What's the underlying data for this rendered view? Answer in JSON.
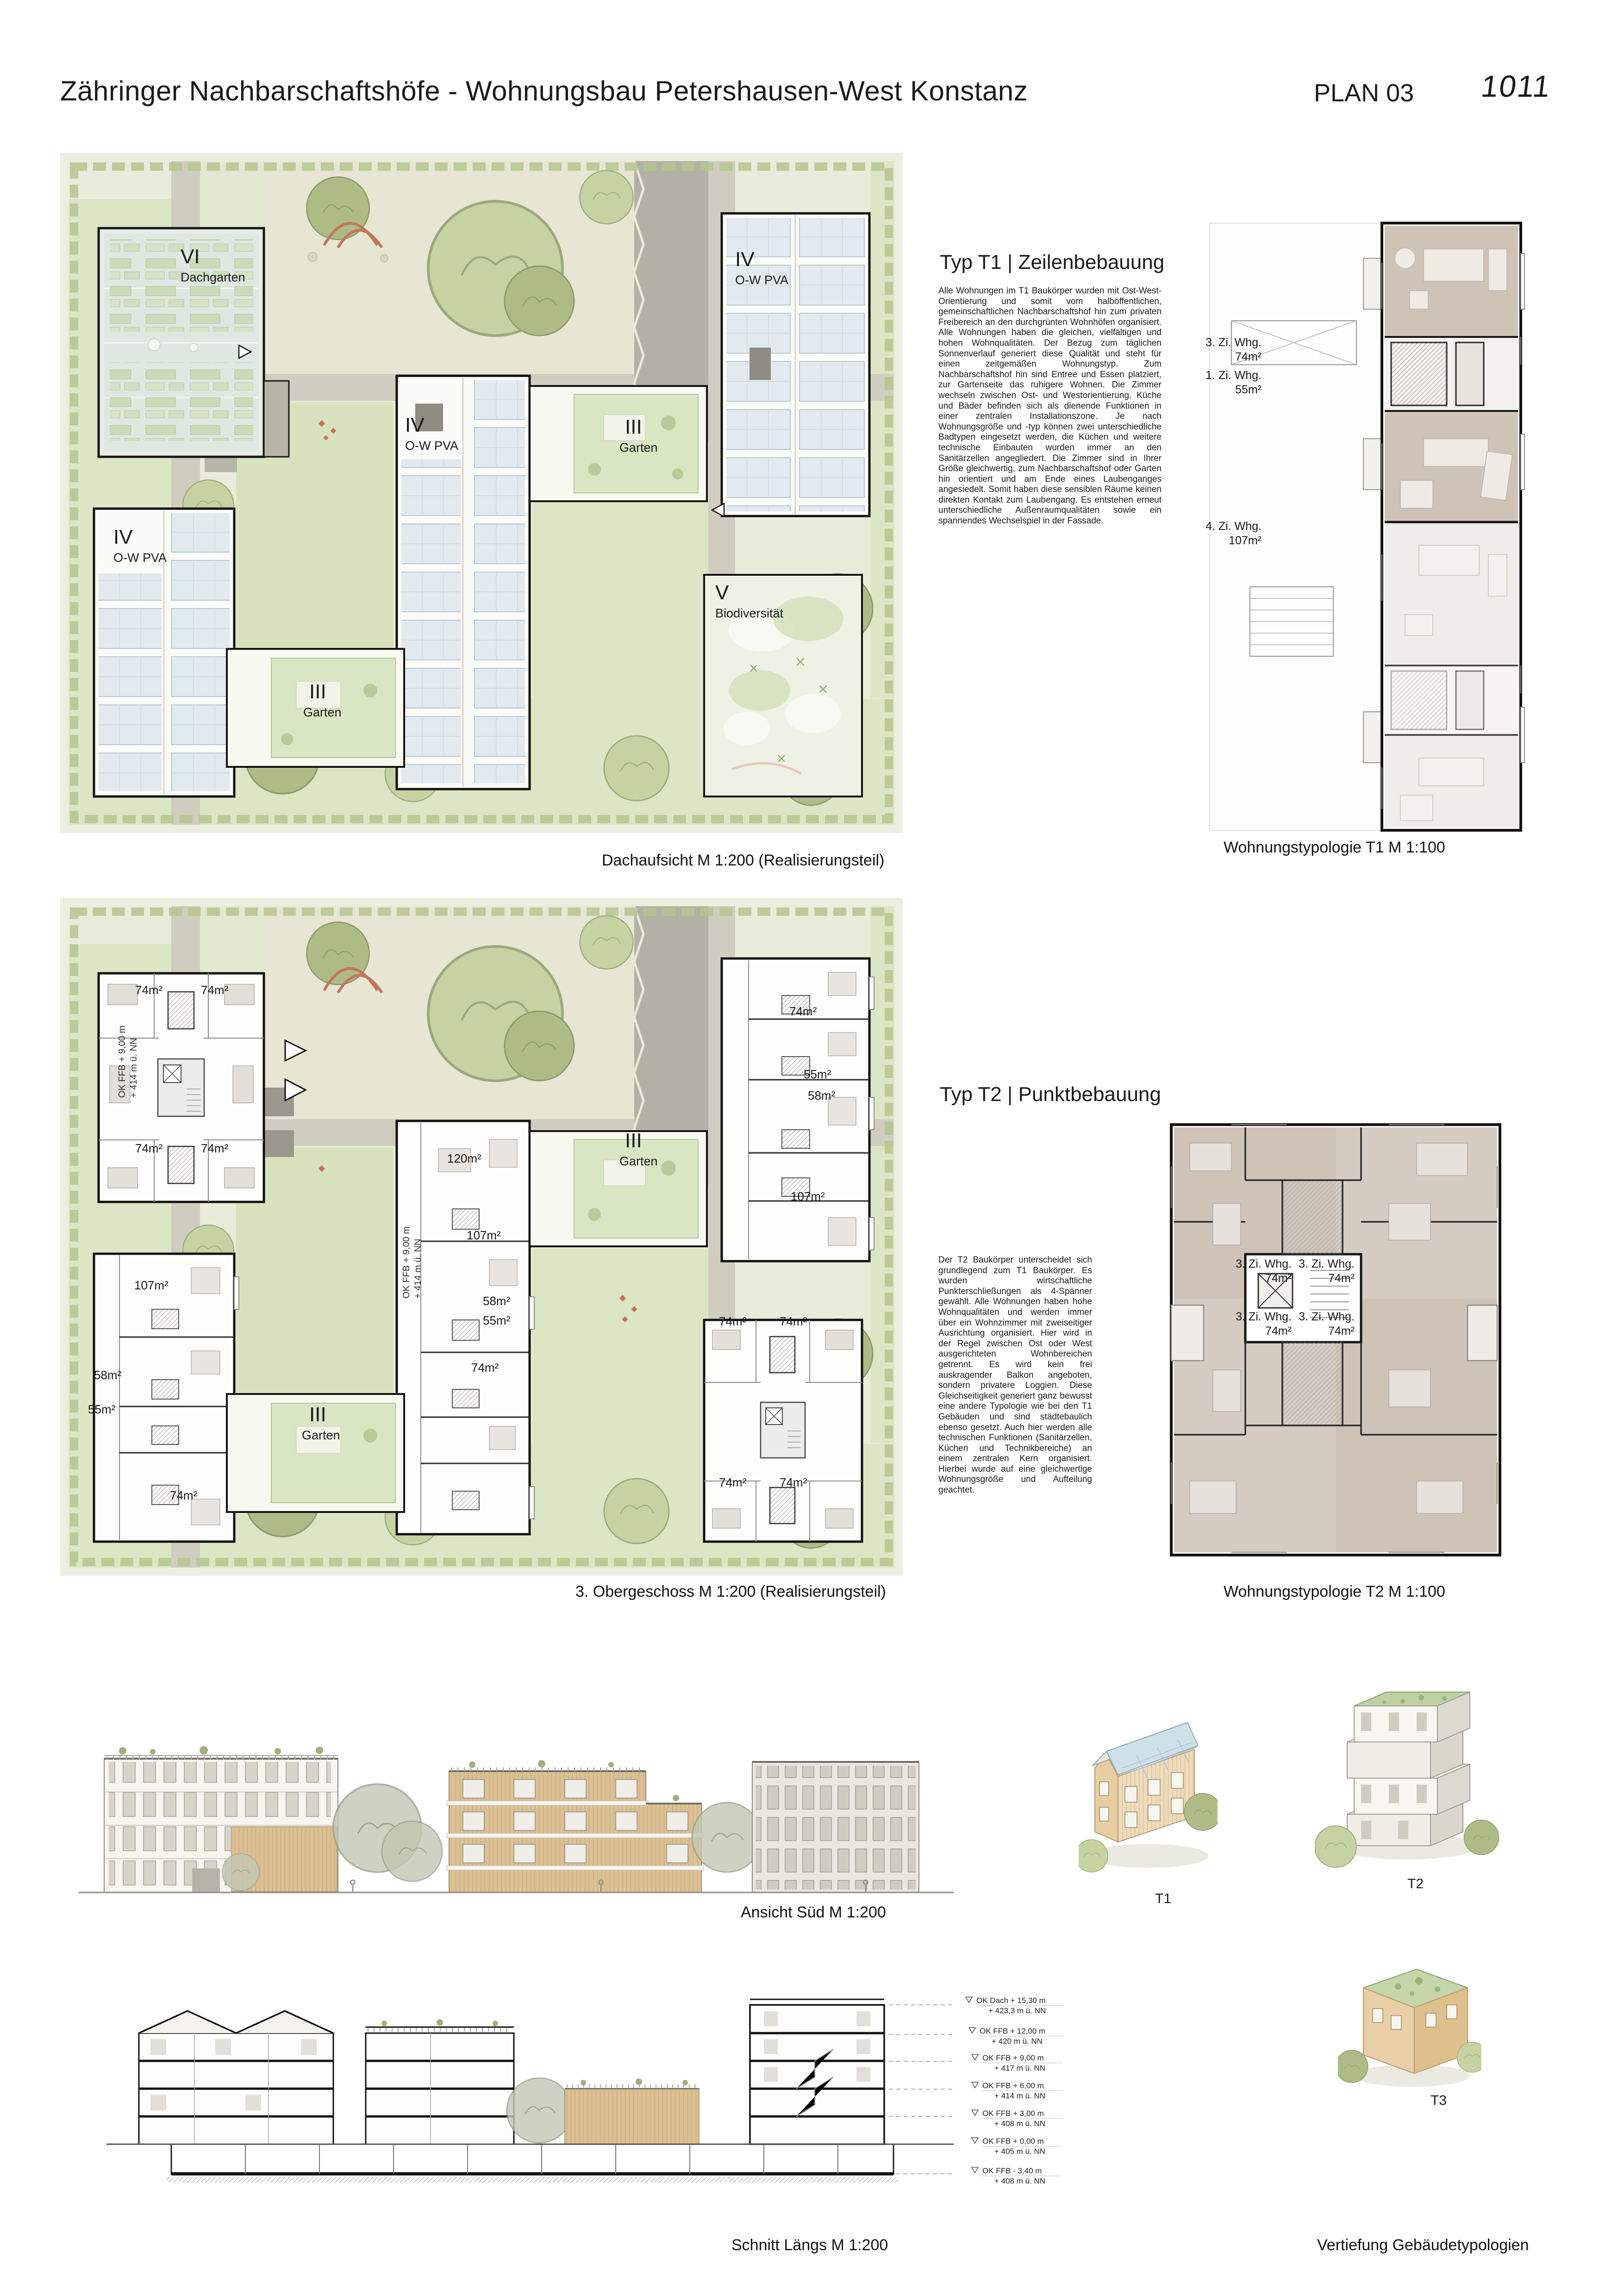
{
  "header": {
    "title": "Zähringer Nachbarschaftshöfe - Wohnungsbau Petershausen-West Konstanz",
    "plan_label": "PLAN 03",
    "entry_number": "1011"
  },
  "colors": {
    "lawn_green": "#dce6c4",
    "hedge_green": "#b5c48e",
    "pv_blue": "#e2eaef",
    "path_gray": "#b3b1a5",
    "unit_taupe": "#cfc3b8",
    "wood_tan": "#dcc194",
    "accent_red": "#ce6b59",
    "ink": "#1a1a1a"
  },
  "roof_plan": {
    "caption": "Dachaufsicht M 1:200 (Realisierungsteil)",
    "labels": {
      "vi": {
        "numeral": "VI",
        "name": "Dachgarten"
      },
      "iv_east": {
        "numeral": "IV",
        "name": "O-W PVA"
      },
      "iv_mid": {
        "numeral": "IV",
        "name": "O-W PVA"
      },
      "iv_west": {
        "numeral": "IV",
        "name": "O-W PVA"
      },
      "iii_east": {
        "numeral": "III",
        "name": "Garten"
      },
      "iii_west": {
        "numeral": "III",
        "name": "Garten"
      },
      "v": {
        "numeral": "V",
        "name": "Biodiversität"
      }
    }
  },
  "og_plan": {
    "caption": "3. Obergeschoss M 1:200 (Realisierungsteil)",
    "level_note": {
      "line1": "OK FFB + 9,00 m",
      "line2": "+ 414 m ü. NN"
    },
    "garden_labels": {
      "east": {
        "numeral": "III",
        "name": "Garten"
      },
      "west": {
        "numeral": "III",
        "name": "Garten"
      }
    },
    "areas": {
      "t2_nw": [
        "74m²",
        "74m²",
        "74m²",
        "74m²"
      ],
      "t1_ne": [
        "74m²",
        "55m²",
        "58m²",
        "107m²"
      ],
      "t1_mid": [
        "120m²",
        "107m²",
        "58m²",
        "55m²",
        "74m²"
      ],
      "t1_sw": [
        "107m²",
        "58m²",
        "55m²",
        "74m²"
      ],
      "t2_se": [
        "74m²",
        "74m²",
        "74m²",
        "74m²"
      ]
    }
  },
  "typ_t1": {
    "heading": "Typ T1 | Zeilenbebauung",
    "body": "Alle Wohnungen im T1 Baukörper wurden mit Ost-West-Orientierung und somit vom halböffentlichen, gemeinschaftlichen Nachbarschaftshof hin zum privaten Freibereich an den durchgrünten Wohnhöfen organisiert. Alle Wohnungen haben die gleichen, vielfältigen und hohen Wohnqualitäten. Der Bezug zum täglichen Sonnenverlauf generiert diese Qualität und steht für einen zeitgemäßen Wohnungstyp. Zum Nachbarschaftshof hin sind Entree und Essen platziert, zur Gartenseite das ruhigere Wohnen. Die Zimmer wechseln zwischen Ost- und Westorientierung. Küche und Bäder befinden sich als dienende Funktionen in einer zentralen Installationszone. Je nach Wohnungsgröße und -typ können zwei unterschiedliche Badtypen eingesetzt werden, die Küchen und weitere technische Einbauten wurden immer an den Sanitärzellen angegliedert. Die Zimmer sind in Ihrer Größe gleichwertig, zum Nachbarschaftshof oder Garten hin orientiert und am Ende eines Laubenganges angesiedelt. Somit haben diese sensiblen Räume keinen direkten Kontakt zum Laubengang. Es entstehen erneut unterschiedliche Außenraumqualitäten sowie ein spannendes Wechselspiel in der Fassade.",
    "plan_caption": "Wohnungstypologie T1 M 1:100",
    "units": [
      {
        "type": "3. Zi. Whg.",
        "area": "74m²"
      },
      {
        "type": "1. Zi. Whg.",
        "area": "55m²"
      },
      {
        "type": "4. Zi. Whg.",
        "area": "107m²"
      }
    ]
  },
  "typ_t2": {
    "heading": "Typ T2 | Punktbebauung",
    "body": "Der T2 Baukörper unterscheidet sich grundlegend zum T1 Baukörper. Es wurden wirtschaftliche Punkterschließungen als 4-Spänner gewählt. Alle Wohnungen haben hohe Wohnqualitäten und werden immer über ein Wohnzimmer mit zweiseitiger Ausrichtung organisiert. Hier wird in der Regel zwischen Ost oder West ausgerichteten Wohnbereichen getrennt. Es wird kein frei auskragender Balkon angeboten, sondern privatere Loggien. Diese Gleichseitigkeit generiert ganz bewusst eine andere Typologie wie bei den T1 Gebäuden und sind städtebaulich ebenso gesetzt. Auch hier werden alle technischen Funktionen (Sanitärzellen, Küchen und Technikbereiche) an einem zentralen Kern organisiert. Hierbei wurde auf eine gleichwertige Wohnungsgröße und Aufteilung geachtet.",
    "plan_caption": "Wohnungstypologie T2 M 1:100",
    "units": [
      {
        "type": "3. Zi. Whg.",
        "area": "74m²"
      },
      {
        "type": "3. Zi. Whg.",
        "area": "74m²"
      },
      {
        "type": "3. Zi. Whg.",
        "area": "74m²"
      },
      {
        "type": "3. Zi. Whg.",
        "area": "74m²"
      }
    ]
  },
  "elevation": {
    "caption": "Ansicht Süd M 1:200"
  },
  "section": {
    "caption": "Schnitt Längs M 1:200",
    "levels": [
      {
        "label": "OK Dach + 15,30 m",
        "altitude": "+ 423,3 m ü. NN"
      },
      {
        "label": "OK FFB + 12,00 m",
        "altitude": "+ 420 m ü. NN"
      },
      {
        "label": "OK FFB + 9,00 m",
        "altitude": "+ 417 m ü. NN"
      },
      {
        "label": "OK FFB + 6,00 m",
        "altitude": "+ 414 m ü. NN"
      },
      {
        "label": "OK FFB + 3,00 m",
        "altitude": "+ 408 m ü. NN"
      },
      {
        "label": "OK FFB + 0,00 m",
        "altitude": "+ 405 m ü. NN"
      },
      {
        "label": "OK FFB - 3,40 m",
        "altitude": "+ 408 m ü. NN"
      }
    ]
  },
  "typologies": {
    "caption": "Vertiefung Gebäudetypologien",
    "items": [
      "T1",
      "T2",
      "T3"
    ]
  }
}
